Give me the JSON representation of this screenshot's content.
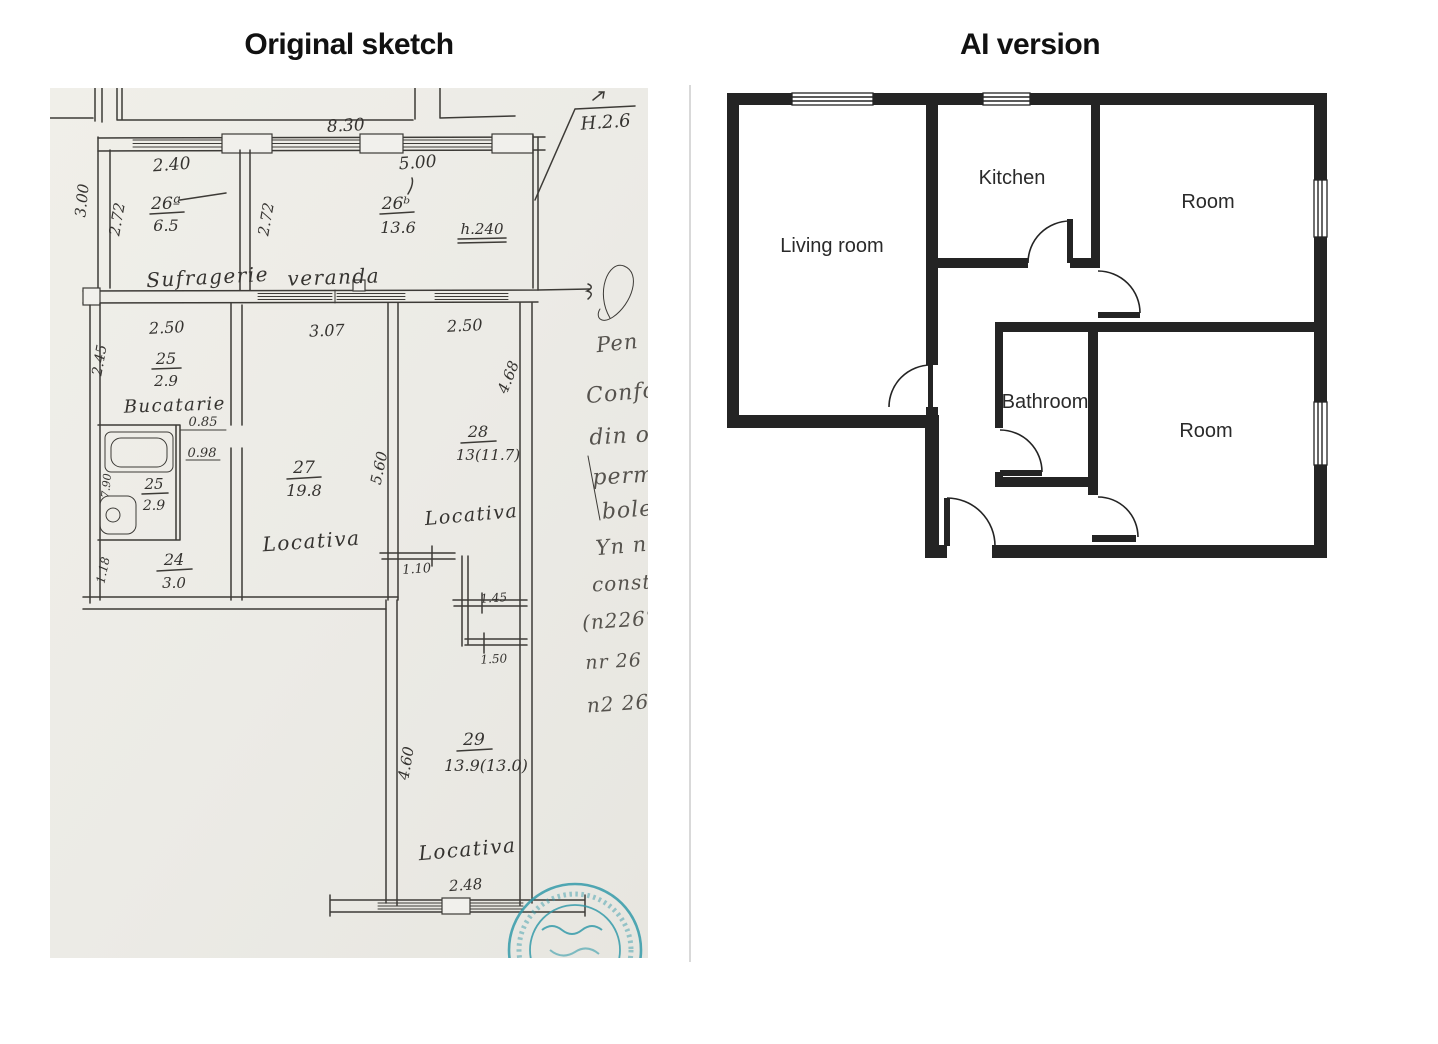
{
  "titles": {
    "left": "Original sketch",
    "right": "AI version"
  },
  "sketch": {
    "dims": {
      "top": "8.30",
      "flag": "H.2.6",
      "suf_w": "2.40",
      "suf_h": "2.72",
      "outer_h": "3.00",
      "ver_w": "5.00",
      "ver_h": "2.72",
      "h240": "h.240",
      "mid1": "2.50",
      "mid2": "3.07",
      "mid3": "2.50",
      "buc_h": "2.45",
      "p085": "0.85",
      "p098": "0.98",
      "bath_h": "7.90",
      "hall_h": "1.18",
      "c_h": "5.60",
      "r_h": "4.68",
      "n110": "1.10",
      "n145": "1.45",
      "n150": "1.50",
      "wing_h": "4.60",
      "wing_w": "2.48"
    },
    "fractions": [
      {
        "n": "26ª",
        "d": "6.5"
      },
      {
        "n": "26ᵇ",
        "d": "13.6"
      },
      {
        "n": "25",
        "d": "2.9"
      },
      {
        "n": "25",
        "d": "2.9"
      },
      {
        "n": "24",
        "d": "3.0"
      },
      {
        "n": "27",
        "d": "19.8"
      },
      {
        "n": "28",
        "d": "13(11.7)"
      },
      {
        "n": "29",
        "d": "13.9(13.0)"
      }
    ],
    "rooms": [
      "Sufragerie",
      "veranda",
      "Bucatarie",
      "Locativa",
      "Locativa",
      "Locativa"
    ],
    "margin_notes": [
      "Pen",
      "Confo",
      "din o",
      "perm",
      "bole",
      "Yn n",
      "const",
      "(n226°",
      "nr 26 b",
      "n2 26°"
    ]
  },
  "ai_plan": {
    "rooms": {
      "living": "Living room",
      "kitchen": "Kitchen",
      "room_top": "Room",
      "bathroom": "Bathroom",
      "room_bottom": "Room"
    }
  },
  "colors": {
    "wall": "#242424",
    "paper": "#edece7",
    "ink": "#3d3b37",
    "pencil": "#55524d",
    "stamp": "#2e98a8",
    "divider": "#d9d9d9"
  }
}
